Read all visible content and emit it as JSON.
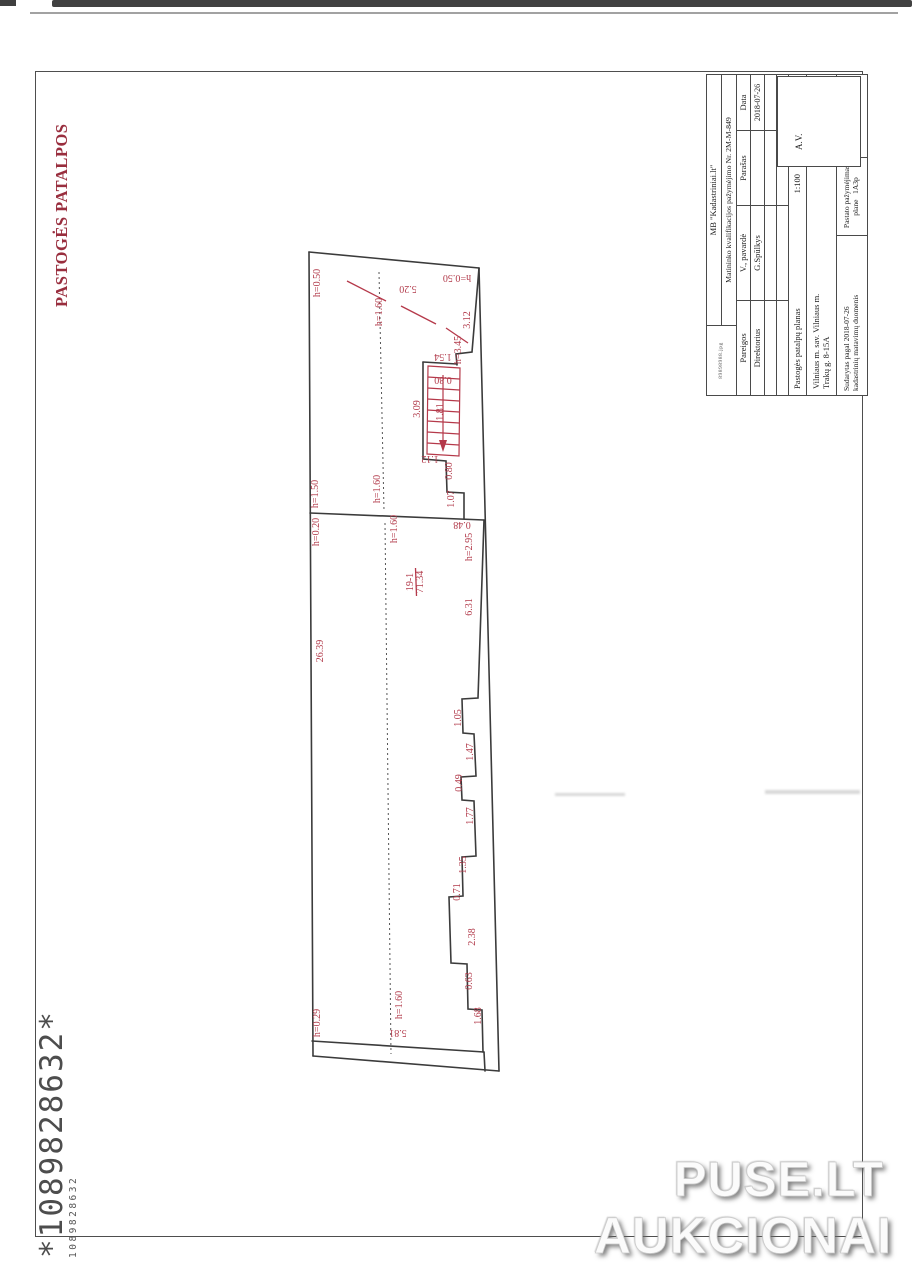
{
  "page": {
    "vertical_title": "PASTOGĖS PATALPOS",
    "barcode_large": "*1089828632*",
    "barcode_small": "1089828632",
    "watermark_line1": "PUSE.LT",
    "watermark_line2": "AUKCIONAI"
  },
  "title_block": {
    "file_note": "89898988.jpg",
    "company": "MB \"Kadastriniai.lt\"",
    "qualification": "Matininko kvalifikacijos pažymėjimo Nr. 2M-M-849",
    "col_position": "Pareigos",
    "col_name": "V., pavardė",
    "col_signature": "Parašas",
    "col_date": "Data",
    "row_position": "Direktorius",
    "row_name": "G.Spūlkys",
    "row_date": "2018-07-26",
    "stamp": "A.V.",
    "plan_title": "Pastogės patalpų planas",
    "scale": "1:100",
    "address_line1": "Vilniaus m. sav. Vilniaus m.",
    "address_line2": "Trakų g. 8-15A",
    "basis_line1": "Sudarytas pagal 2018-07-26",
    "basis_line2": "kadastrinių matavimų duomenis",
    "mark_label1": "Pastato pažymėjimas",
    "mark_label2": "plane",
    "mark_value": "1A3p"
  },
  "plan": {
    "room_number": "19-1",
    "room_area": "71.34",
    "line_color": "#3b3b3b",
    "annotation_color": "#b23b4b",
    "labels": [
      {
        "text": "h=0.50",
        "x": 318,
        "y": 283,
        "rot": -90
      },
      {
        "text": "5.20",
        "x": 408,
        "y": 288,
        "rot": 180
      },
      {
        "text": "h=1.60",
        "x": 380,
        "y": 312,
        "rot": -90
      },
      {
        "text": "h=0.50",
        "x": 457,
        "y": 277,
        "rot": 180
      },
      {
        "text": "3.12",
        "x": 468,
        "y": 320,
        "rot": -90
      },
      {
        "text": "h=3.45",
        "x": 459,
        "y": 350,
        "rot": -90
      },
      {
        "text": "1.54",
        "x": 443,
        "y": 356,
        "rot": 180
      },
      {
        "text": "0.80",
        "x": 443,
        "y": 379,
        "rot": 180
      },
      {
        "text": "3.09",
        "x": 418,
        "y": 409,
        "rot": -90
      },
      {
        "text": "1.81",
        "x": 441,
        "y": 412,
        "rot": -90
      },
      {
        "text": "1.12",
        "x": 430,
        "y": 458,
        "rot": 180
      },
      {
        "text": "0.80",
        "x": 450,
        "y": 471,
        "rot": -90
      },
      {
        "text": "1.07",
        "x": 452,
        "y": 499,
        "rot": -90
      },
      {
        "text": "h=1.50",
        "x": 316,
        "y": 494,
        "rot": -90
      },
      {
        "text": "h=1.60",
        "x": 378,
        "y": 489,
        "rot": -90
      },
      {
        "text": "h=0.20",
        "x": 317,
        "y": 532,
        "rot": -90
      },
      {
        "text": "h=1.60",
        "x": 395,
        "y": 529,
        "rot": -90
      },
      {
        "text": "0.48",
        "x": 462,
        "y": 524,
        "rot": 180
      },
      {
        "text": "h=2.95",
        "x": 470,
        "y": 547,
        "rot": -90
      },
      {
        "text": "19-1",
        "x": 411,
        "y": 582,
        "rot": -90
      },
      {
        "text": "71.34",
        "x": 421,
        "y": 582,
        "rot": -90
      },
      {
        "text": "6.31",
        "x": 470,
        "y": 607,
        "rot": -90
      },
      {
        "text": "26.39",
        "x": 321,
        "y": 651,
        "rot": -90
      },
      {
        "text": "1.05",
        "x": 459,
        "y": 718,
        "rot": -90
      },
      {
        "text": "1.47",
        "x": 471,
        "y": 752,
        "rot": -90
      },
      {
        "text": "0.49",
        "x": 460,
        "y": 783,
        "rot": -90
      },
      {
        "text": "1.77",
        "x": 471,
        "y": 816,
        "rot": -90
      },
      {
        "text": "1.35",
        "x": 464,
        "y": 865,
        "rot": -90
      },
      {
        "text": "0.71",
        "x": 458,
        "y": 892,
        "rot": -90
      },
      {
        "text": "2.38",
        "x": 473,
        "y": 937,
        "rot": -90
      },
      {
        "text": "0.63",
        "x": 470,
        "y": 981,
        "rot": -90
      },
      {
        "text": "1.68",
        "x": 479,
        "y": 1016,
        "rot": -90
      },
      {
        "text": "h=0.29",
        "x": 318,
        "y": 1023,
        "rot": -90
      },
      {
        "text": "h=1.60",
        "x": 400,
        "y": 1005,
        "rot": -90
      },
      {
        "text": "5.81",
        "x": 398,
        "y": 1032,
        "rot": 180
      }
    ]
  }
}
